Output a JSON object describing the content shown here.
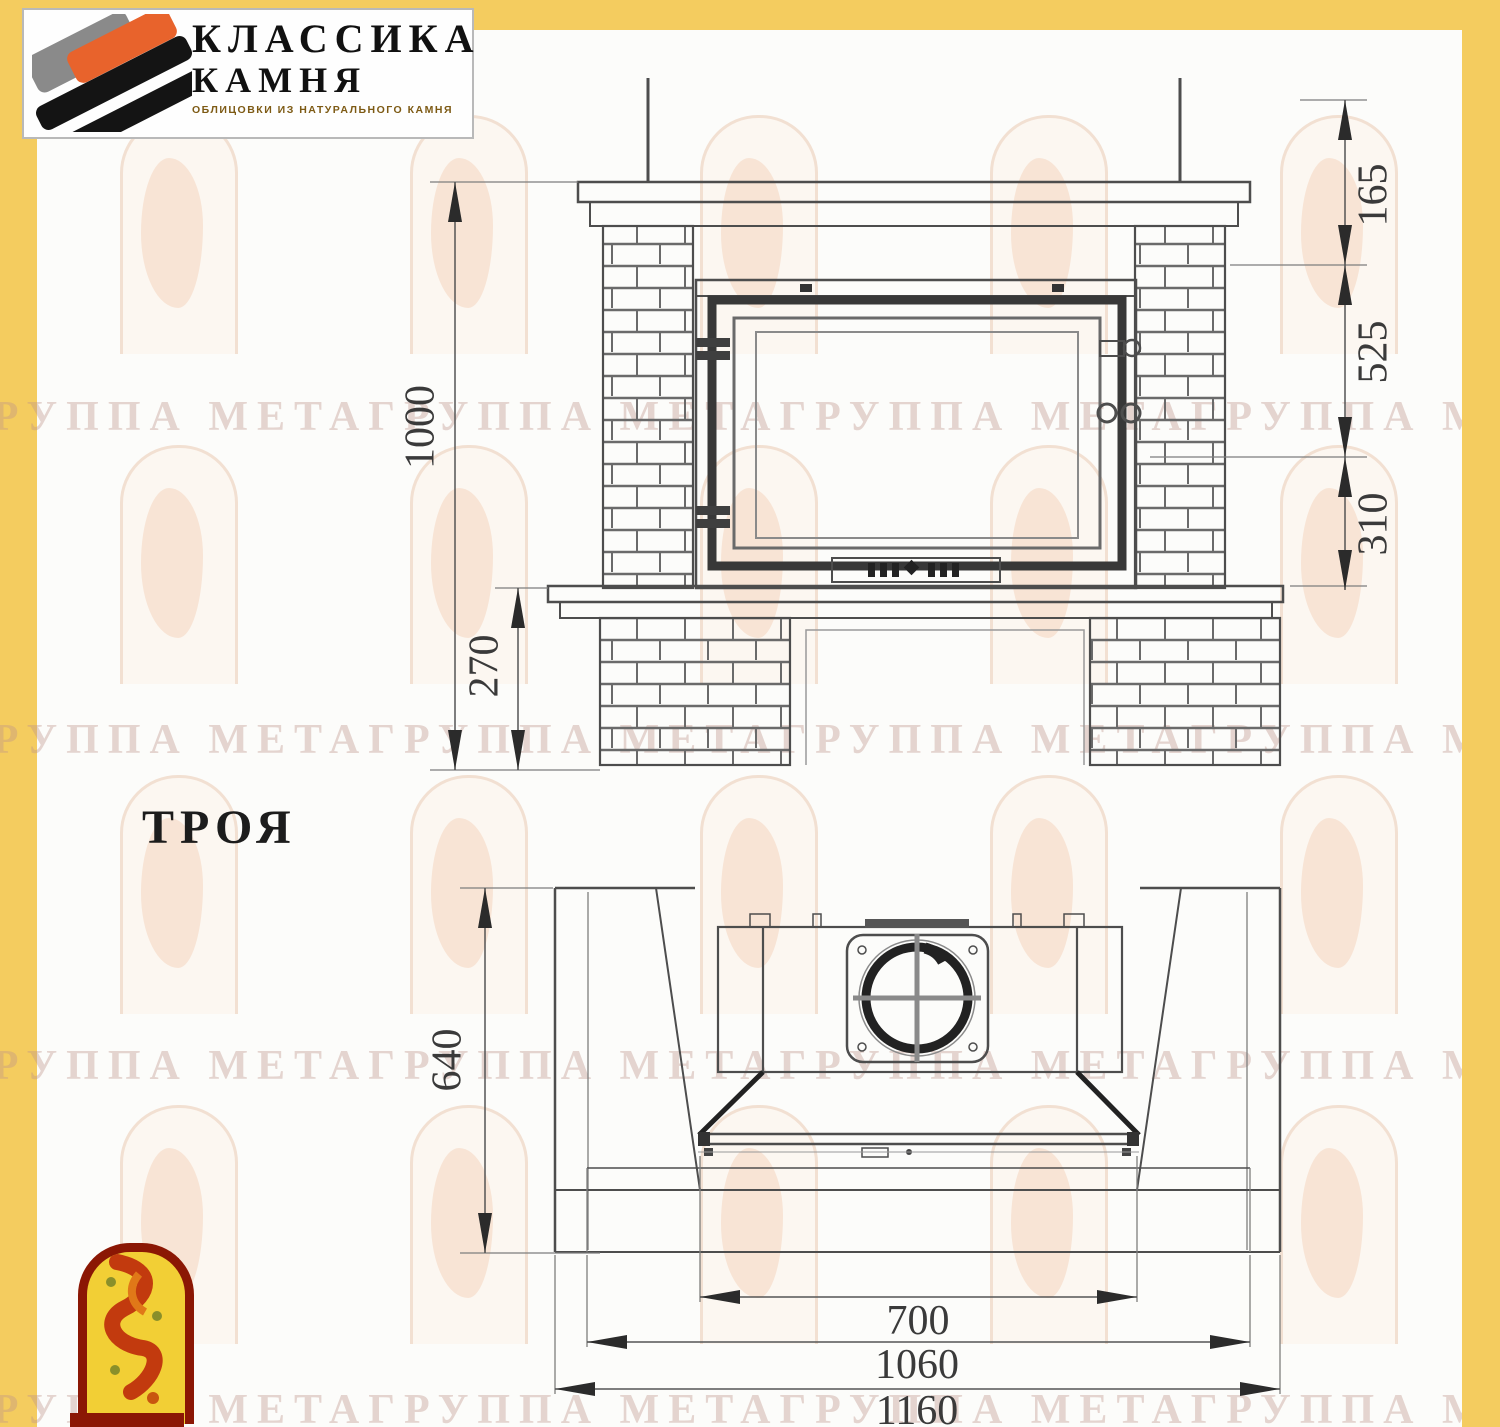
{
  "logo": {
    "line1": "КЛАССИКА",
    "line2": "КАМНЯ",
    "tagline": "ОБЛИЦОВКИ ИЗ НАТУРАЛЬНОГО КАМНЯ",
    "colors": {
      "orange": "#E8632C",
      "gray": "#8A8A8A",
      "black": "#141414"
    }
  },
  "model_label": "ТРОЯ",
  "watermark": {
    "text": "ГРУППА МЕТАГРУППА МЕТАГРУППА МЕТАГРУППА МЕТАГРУППА МЕТА"
  },
  "page_colors": {
    "frame": "#F4CC5F",
    "paper": "#FCFCFA",
    "line": "#4D4D4D"
  },
  "dimensions": {
    "front_view": {
      "total_height": "1000",
      "base_height": "270",
      "top_segment": "165",
      "middle_segment": "525",
      "bottom_segment": "310"
    },
    "plan_view": {
      "depth": "640",
      "opening_width": "700",
      "hearth_width": "1060",
      "total_width": "1160"
    }
  }
}
